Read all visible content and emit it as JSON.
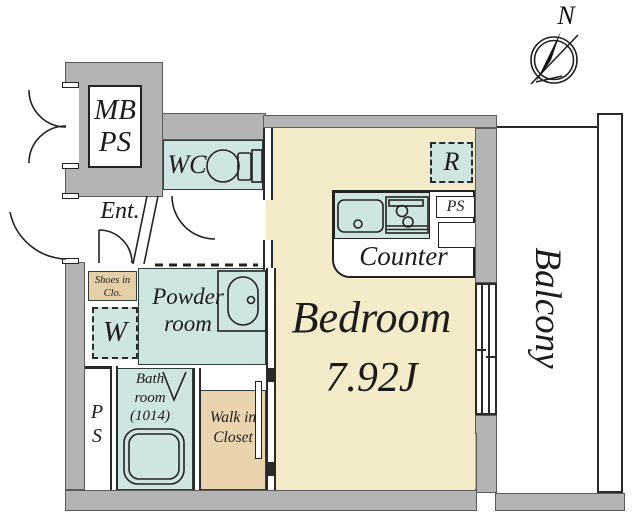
{
  "rooms": {
    "mbps": {
      "line1": "MB",
      "line2": "PS"
    },
    "wc": {
      "label": "WC"
    },
    "entrance": {
      "label": "Ent."
    },
    "shoes": {
      "line1": "Shoes in",
      "line2": "Clo."
    },
    "washer": {
      "label": "W"
    },
    "powder": {
      "line1": "Powder",
      "line2": "room"
    },
    "bath": {
      "line1": "Bath",
      "line2": "room",
      "line3": "(1014)"
    },
    "ps_shaft": {
      "line1": "P",
      "line2": "S"
    },
    "walk_in_closet": {
      "line1": "Walk in",
      "line2": "Closet"
    },
    "bedroom": {
      "name": "Bedroom",
      "area": "7.92J"
    },
    "counter": {
      "label": "Counter"
    },
    "kitchen_ps": {
      "label": "PS"
    },
    "fridge": {
      "label": "R"
    },
    "balcony": {
      "label": "Balcony"
    }
  },
  "compass": {
    "label": "N"
  },
  "colors": {
    "wall": "#b4b4b4",
    "teal": "#cfe5e1",
    "cream": "#f4ebc8",
    "tan": "#e9d4ad",
    "line": "#2a2a2a"
  }
}
